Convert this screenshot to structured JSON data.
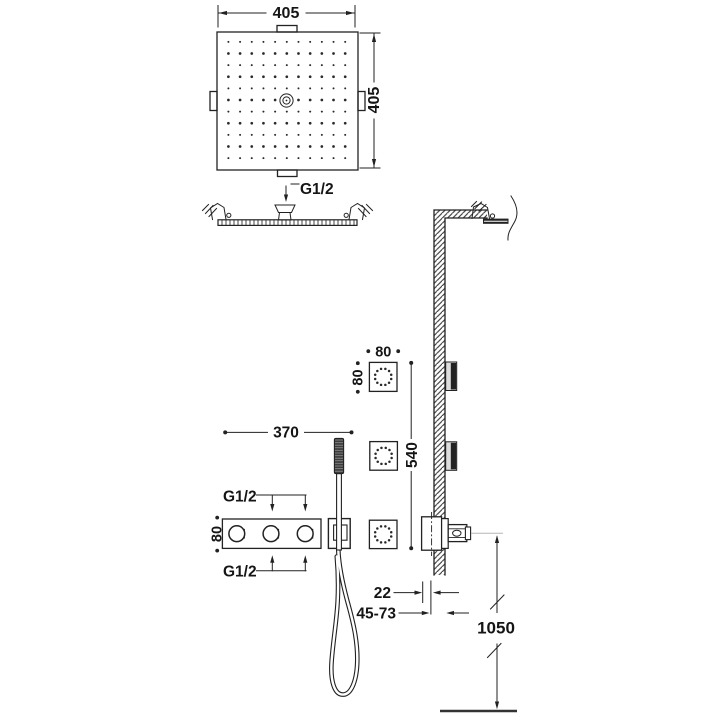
{
  "drawing": {
    "overhead_shower": {
      "width": "405",
      "height": "405",
      "connection": "G1/2"
    },
    "body_jet": {
      "width": "80",
      "height": "80",
      "vertical_span": "540"
    },
    "mixer": {
      "width": "370",
      "height": "80",
      "connection_top": "G1/2",
      "connection_bottom": "G1/2"
    },
    "installation": {
      "wall_offset": "22",
      "depth_range": "45-73",
      "height_from_floor": "1050"
    }
  },
  "colors": {
    "line": "#222222",
    "background": "#ffffff"
  }
}
